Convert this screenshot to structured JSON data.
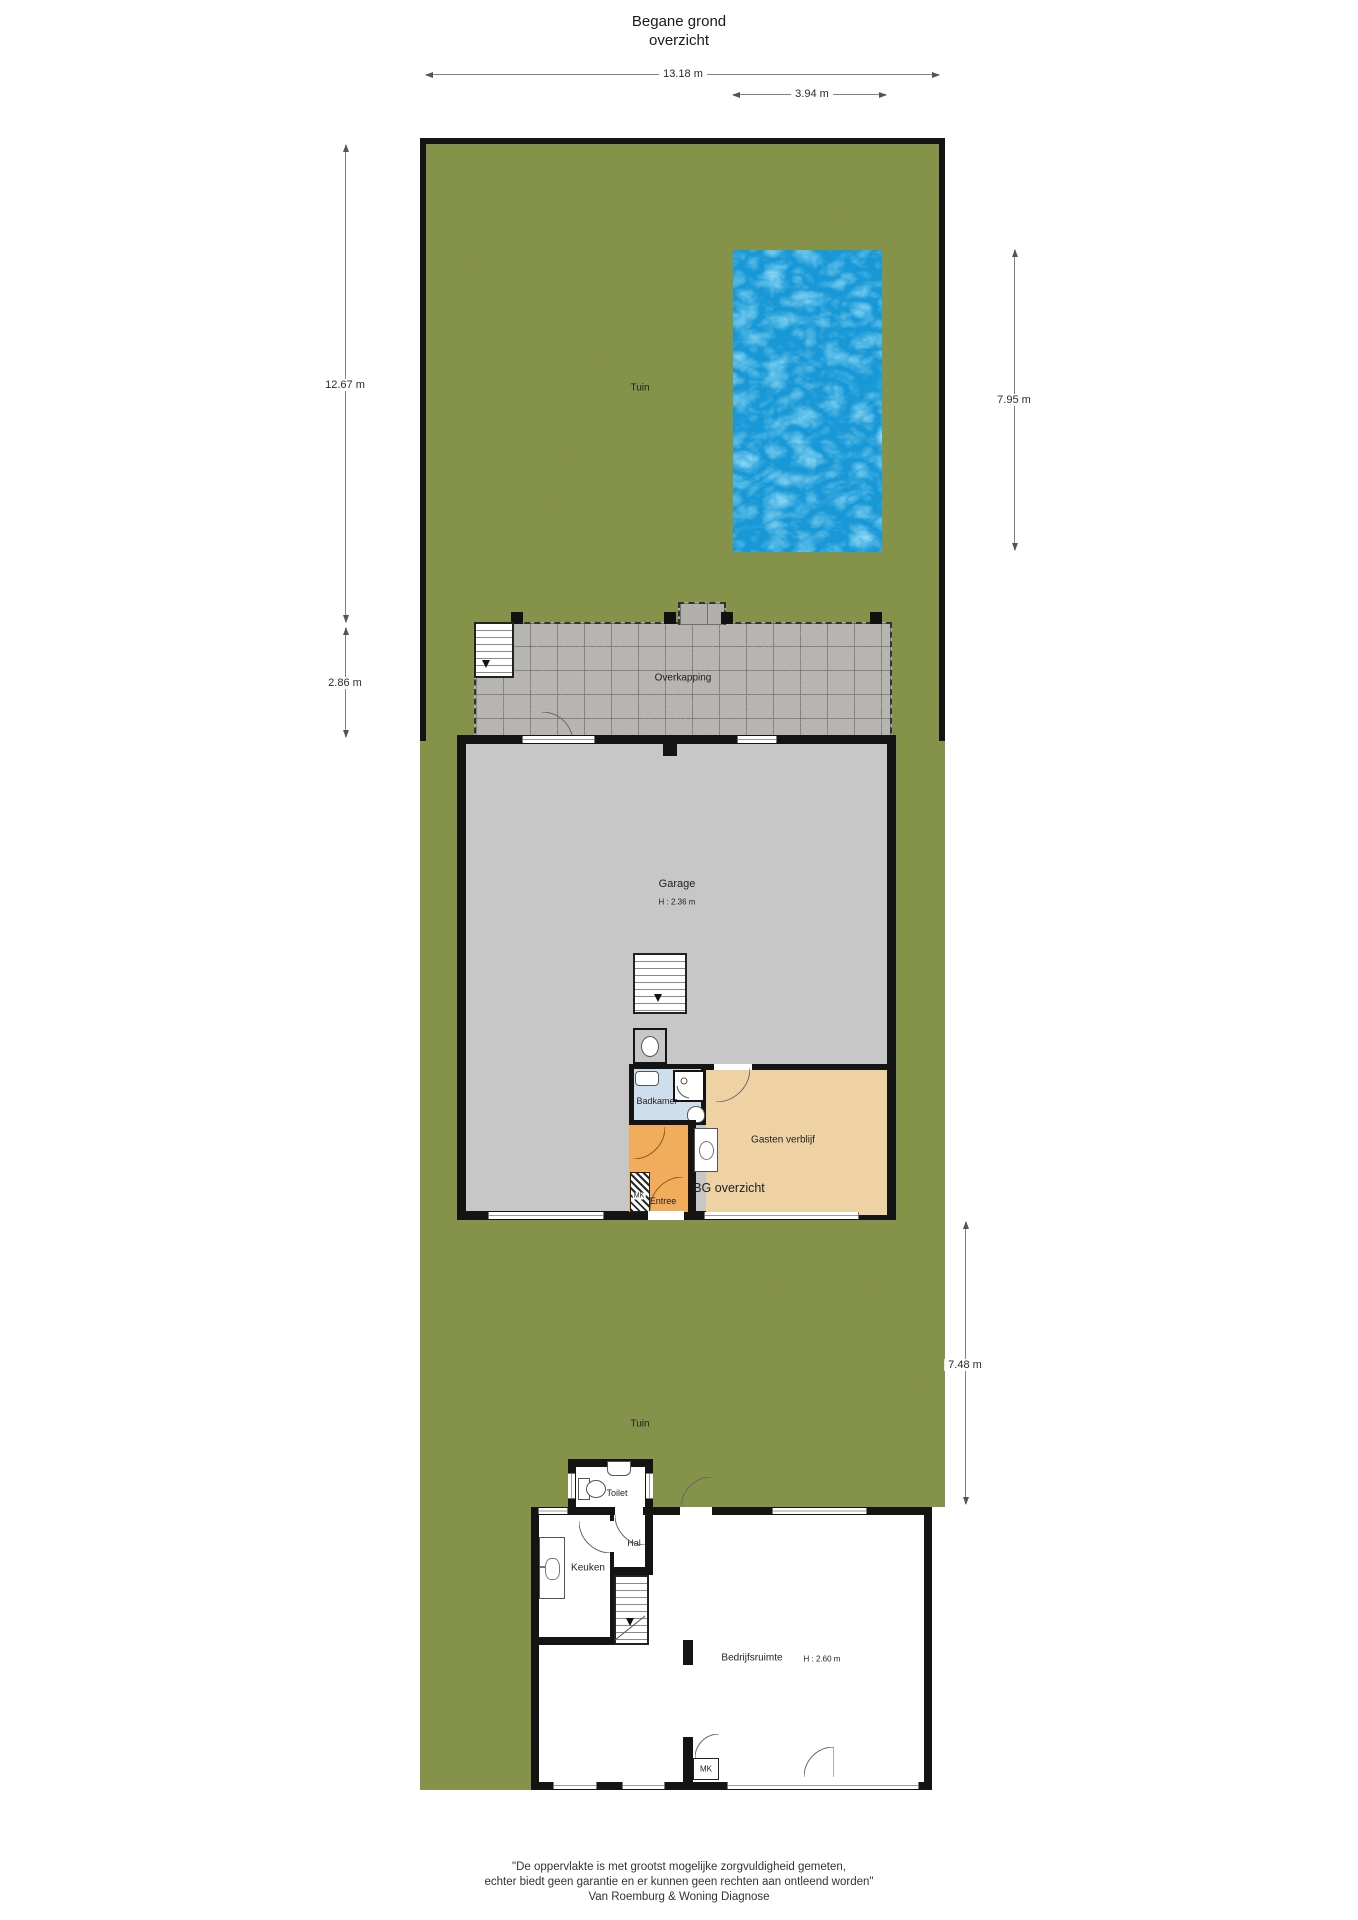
{
  "title": {
    "line1": "Begane grond",
    "line2": "overzicht"
  },
  "dimensions": {
    "plot_width": "13.18 m",
    "pool_width": "3.94 m",
    "garden_upper_height": "12.67 m",
    "overkapping_height": "2.86 m",
    "pool_height": "7.95 m",
    "garden_lower_height": "7.48 m"
  },
  "rooms": {
    "tuin_upper": "Tuin",
    "overkapping": "Overkapping",
    "garage": "Garage",
    "garage_height": "H : 2.36 m",
    "badkamer": "Badkamer",
    "gasten_verblijf": "Gasten verblijf",
    "entree": "Entree",
    "mk_garage": "MK",
    "bg_overzicht": "BG overzicht",
    "tuin_lower": "Tuin",
    "toilet": "Toilet",
    "hal": "Hal",
    "keuken": "Keuken",
    "bedrijfsruimte": "Bedrijfsruimte",
    "bedrijfsruimte_height": "H : 2.60 m",
    "mk_bottom": "MK"
  },
  "footer": {
    "line1": "\"De oppervlakte is met grootst mogelijke zorgvuldigheid gemeten,",
    "line2": "echter biedt geen garantie en er kunnen geen rechten aan ontleend worden\"",
    "line3": "Van Roemburg & Woning Diagnose"
  },
  "colors": {
    "grass": "#84924c",
    "pool_water": "#1898d6",
    "paving": "#b2b0ad",
    "garage_floor": "#c7c7c7",
    "badkamer": "#cfdeed",
    "gasten_verblijf": "#eed2a3",
    "entree": "#f1ad5b",
    "wall": "#141414"
  }
}
